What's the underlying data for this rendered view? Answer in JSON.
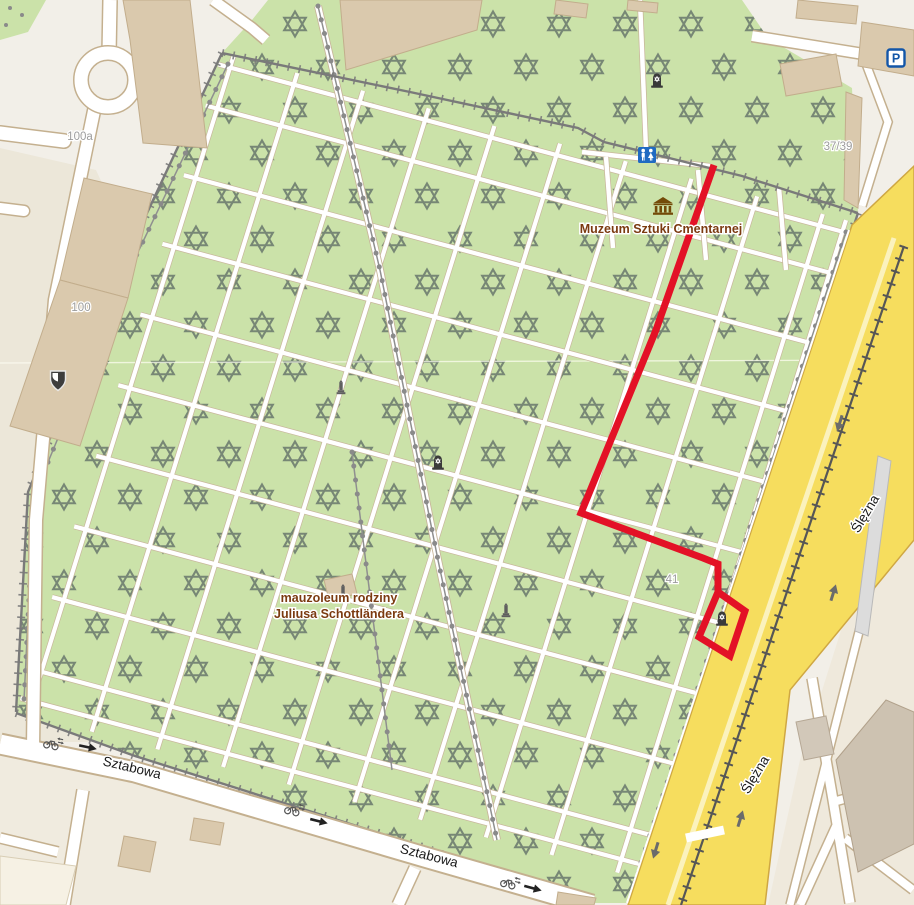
{
  "map": {
    "kind": "openstreetmap-style city map with walking route",
    "labels": {
      "museum": "Muzeum Sztuki Cmentarnej",
      "mausoleum_line1": "mauzoleum rodziny",
      "mausoleum_line2": "Juliusa Schottländera",
      "street_sztabowa": "Sztabowa",
      "street_slezna": "Ślężna",
      "hn_100a": "100a",
      "hn_100": "100",
      "hn_37_39": "37/39",
      "hn_41": "41"
    },
    "icon_glyphs": {
      "parking": "P"
    },
    "colors": {
      "cemetery_green": "#cbe2a9",
      "star_gray": "#68776c",
      "road_yellow": "#f6dd5e",
      "road_yellow_casing": "#cfa743",
      "route_red": "#e31126",
      "building_tan": "#dac9ad",
      "wall_gray": "#7a7a7a",
      "poi_label_brown": "#7b3a10",
      "housenumber_gray": "#9c9c9c",
      "parking_blue": "#1356a8",
      "toilets_blue": "#1f6ac2",
      "museum_brown": "#734a08"
    },
    "icons": [
      {
        "name": "parking",
        "x": 896,
        "y": 58,
        "rot": 0
      },
      {
        "name": "toilets",
        "x": 647,
        "y": 155,
        "rot": 0
      },
      {
        "name": "museum",
        "x": 663,
        "y": 206,
        "rot": 0
      },
      {
        "name": "memorial",
        "x": 657,
        "y": 80,
        "rot": 0
      },
      {
        "name": "memorial",
        "x": 438,
        "y": 462,
        "rot": 0
      },
      {
        "name": "memorial",
        "x": 722,
        "y": 618,
        "rot": 0
      },
      {
        "name": "monument",
        "x": 341,
        "y": 388,
        "rot": 0
      },
      {
        "name": "monument",
        "x": 343,
        "y": 592,
        "rot": 0
      },
      {
        "name": "monument",
        "x": 506,
        "y": 611,
        "rot": 0
      },
      {
        "name": "shield",
        "x": 58,
        "y": 380,
        "rot": 0
      },
      {
        "name": "bicycle-both",
        "x": 52,
        "y": 744,
        "rot": 12
      },
      {
        "name": "bicycle-both",
        "x": 293,
        "y": 810,
        "rot": 14
      },
      {
        "name": "bicycle-both",
        "x": 509,
        "y": 883,
        "rot": 15
      },
      {
        "name": "oneway-arrow",
        "x": 87,
        "y": 747,
        "rot": 12
      },
      {
        "name": "oneway-arrow",
        "x": 318,
        "y": 821,
        "rot": 14
      },
      {
        "name": "oneway-arrow",
        "x": 532,
        "y": 888,
        "rot": 15
      },
      {
        "name": "road-arrow",
        "x": 840,
        "y": 422,
        "rot": 107
      },
      {
        "name": "road-arrow",
        "x": 656,
        "y": 849,
        "rot": 107
      },
      {
        "name": "road-arrow",
        "x": 833,
        "y": 594,
        "rot": -73
      },
      {
        "name": "road-arrow",
        "x": 740,
        "y": 820,
        "rot": -73
      }
    ],
    "route": {
      "color": "#e31126",
      "width": 7,
      "points": [
        [
          714,
          165
        ],
        [
          656,
          330
        ],
        [
          581,
          513
        ],
        [
          703,
          558
        ],
        [
          718,
          564
        ],
        [
          718,
          592
        ],
        [
          745,
          611
        ],
        [
          730,
          656
        ],
        [
          699,
          637
        ],
        [
          718,
          592
        ]
      ]
    }
  }
}
